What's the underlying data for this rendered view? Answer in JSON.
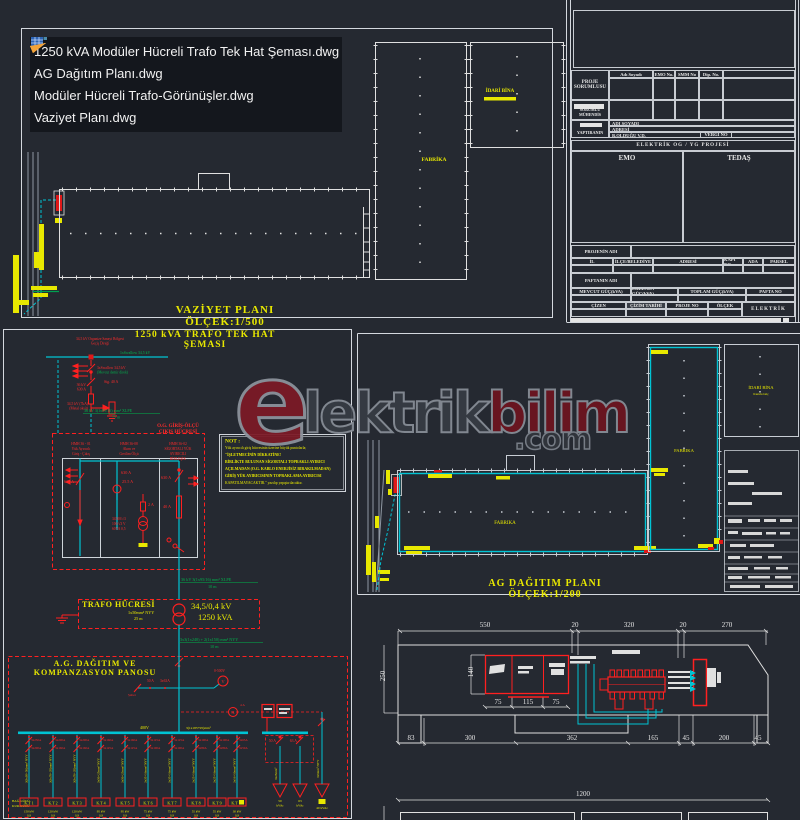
{
  "file_list": {
    "items": [
      "1250 kVA Modüler Hücreli Trafo Tek Hat Şeması.dwg",
      "AG Dağıtım Planı.dwg",
      "Modüler Hücreli Trafo-Görünüşler.dwg",
      "Vaziyet Planı.dwg"
    ]
  },
  "watermark": {
    "logo_letter": "e",
    "part1": "lektrik",
    "part2": "bilim",
    "suffix": ".com"
  },
  "vaziyet": {
    "title": "VAZİYET PLANI ÖLÇEK:1/500",
    "fabrika": "FABRİKA",
    "idari_bina": "İDARİ BİNA"
  },
  "title_block": {
    "proje_sorumlusu": "PROJE SORUMLUSU",
    "adi_soyadi": "Adı Soyadı",
    "emo_no": "EMO No.",
    "smm_no": "SMM No",
    "dip_no": "Dip. No.",
    "sorumlu": "SORUMLU MÜHENDİS",
    "yaptiranin": "YAPTIRANIN",
    "row_adi": "ADI SOYADI",
    "row_adresi": "ADRESİ",
    "row_vd": "B.OLDUĞU V.D.",
    "vergi": "VERGİ NO",
    "band": "ELEKTRİK OG / YG PROJESİ",
    "emo": "EMO",
    "tedas": "TEDAŞ",
    "projenin_adi": "PROJENİN ADI",
    "il": "İL",
    "ilce": "İLÇE/BELEDİYE",
    "adresi": "ADRESİ",
    "kapi_no": "KAPI NO",
    "ada": "ADA",
    "parsel": "PARSEL",
    "paftanin_adi": "PAFTANIN ADI",
    "mevcut": "MEVCUT GÜÇ(kVA)",
    "eklenen": "EKLENEN GÜÇ(kVA)",
    "toplam": "TOPLAM GÜÇ(kVA)",
    "pafta_no": "PAFTA NO",
    "cizen": "ÇİZEN",
    "cizim_tarihi": "ÇİZİM TARİHİ",
    "proje_no": "PROJE NO",
    "olcek": "ÖLÇEK",
    "elektrik": "ELEKTRİK"
  },
  "tekhat": {
    "title": "1250 kVA TRAFO TEK HAT ŞEMASI",
    "incoming_line1": "34,5 kV Organize Sanayi Bölgesi",
    "incoming_line2": "Geçiş Direği",
    "conductor": "1xSwallow 34,5 kV",
    "branch_red": "3xSwallow 34,5 kV",
    "branch_green": "(Mevcut demir direk)",
    "switch_label1": "36 kV",
    "switch_label2": "630 A",
    "fuse_label": "Sig. 40 A",
    "arrester1": "34,5 kV (7kA)",
    "arrester2": "(Metal oksit)",
    "drop_cable": "36 kV 3(1x95/16) mm² XLPE",
    "drop_cable_len": "75 m",
    "og_label1": "O.G. GİRİŞ-ÖLÇÜ",
    "og_label2": "ÇIKIŞ HÜCRESİ",
    "cells": [
      {
        "l1": "HMH 36 - 01",
        "l2": "Yük Ayırıcılı",
        "l3": "Giriş - Çıkış",
        "l4": ""
      },
      {
        "l1": "HMH 36-08",
        "l2": "Akım ve",
        "l3": "Gerilim Ölçü",
        "l4": ""
      },
      {
        "l1": "HMH 36-02",
        "l2": "SİGORTALI YÜK",
        "l3": "AYIRICILI",
        "l4": "BİRLEŞİK"
      }
    ],
    "r630_1": "630 A",
    "r630_2": "630 A",
    "r255": "25.5 A",
    "r2": "2 A",
    "r40": "40 A",
    "r630_3": "630 A",
    "vt1": "34500/√3",
    "vt2": "100/√3 V",
    "vt3": "60VA 0,5",
    "out_cable1": "36 kV 3(1x95/16) mm² XLPE",
    "out_cable1_len": "10 m",
    "not_title": "NOT :",
    "not_lines": [
      "Yük ayırıcılı giriş hücresinin üzerine büyük puntolarla;",
      "\"İŞLETMECİNİN DİKKATİNE!",
      "BİRLİKTE BULUNAN SİGORTALI TOPRAKLI AYIRICI",
      "AÇILMADAN (O.G. KABLO ENERJİSİZ BIRAKILMADAN)",
      "GİRİŞ YÜK AYIRICISININ TOPRAKLAMA AYIRICISI",
      "KAPATILMAYACAKTIR.\" yazılıp yapıştırılacaktır."
    ],
    "trafo_box": "TRAFO HÜCRESİ",
    "trafo_cable": "1x50mm² NYY",
    "trafo_cable_len": "25 m",
    "trafo_kv": "34,5/0,4 kV",
    "trafo_kva": "1250 kVA",
    "out_cable2": "3x3(1x240) + 2(1x150) mm² NYY",
    "out_cable2_len": "10 m",
    "ag_title1": "A.G. DAĞITIM VE",
    "ag_title2": "KOMPANZASYON PANOSU",
    "voltmeter": "V",
    "voltmeter_range": "0-500V",
    "ammeter": "A",
    "ammeter_label": "4 A",
    "salter": "Şalter",
    "sw_a": "50 A",
    "sw_b": "3x63A",
    "busbar_label": "400V",
    "busbar_spec": "3(1x185+95)mm²",
    "corner1": "BAĞ.GÜCÜ",
    "corner2": "KUR.GÜCÜ",
    "feeders": [
      {
        "a": "3x250A",
        "b": "3x200A",
        "c": "3(3x95+50)mm² NYY",
        "tag": "K.T 1",
        "l1": "150 kW",
        "l2": "0,9"
      },
      {
        "a": "3x200A",
        "b": "3x160A",
        "c": "3(3x70+35)mm² NYY",
        "tag": "K.T 2",
        "l1": "120 kW",
        "l2": "0,9"
      },
      {
        "a": "3x200A",
        "b": "3x160A",
        "c": "3(3x70+35)mm² NYY",
        "tag": "K.T 3",
        "l1": "120 kW",
        "l2": "0,9"
      },
      {
        "a": "3x160A",
        "b": "3x125A",
        "c": "3x50+25mm² NYY",
        "tag": "K.T 4",
        "l1": "95 kW",
        "l2": "0,9"
      },
      {
        "a": "3x160A",
        "b": "3x125A",
        "c": "3x50+25mm² NYY",
        "tag": "K.T 5",
        "l1": "95 kW",
        "l2": "0,9"
      },
      {
        "a": "3x125A",
        "b": "3x100A",
        "c": "3x35+16mm² NYY",
        "tag": "K.T 6",
        "l1": "75 kW",
        "l2": "0,9"
      },
      {
        "a": "3x125A",
        "b": "3x100A",
        "c": "3x35+16mm² NYY",
        "tag": "K.T 7",
        "l1": "75 kW",
        "l2": "0,9"
      },
      {
        "a": "3x100A",
        "b": "3x80A",
        "c": "3x25+16mm² NYY",
        "tag": "K.T 8",
        "l1": "55 kW",
        "l2": "0,9"
      },
      {
        "a": "3x100A",
        "b": "3x80A",
        "c": "3x25+16mm² NYY",
        "tag": "K.T 9",
        "l1": "55 kW",
        "l2": "0,9"
      },
      {
        "a": "3x63A",
        "b": "3x50A",
        "c": "3x16+10mm² NYY",
        "tag": "K.T 10",
        "l1": "30 kW",
        "l2": "0,9"
      }
    ],
    "comp": {
      "b1": "50 A",
      "b2": "63 A",
      "c1a": "50",
      "c1b": "kVAr",
      "c2a": "63",
      "c2b": "kVAr",
      "c3": "40 kVAr",
      "cable1": "3x25mm²",
      "cable2": "3x6mm² NYY"
    }
  },
  "agplan": {
    "title": "AG DAĞITIM PLANI ÖLÇEK:1/200",
    "fabrika1": "FABRIKA",
    "fabrika2": "FABRIKA",
    "idari": "İDARİ BİNA",
    "idari_sub": "Kurulu Güç"
  },
  "dims": {
    "top": [
      "550",
      "20",
      "320",
      "20",
      "270"
    ],
    "left": [
      "250",
      "140"
    ],
    "cells": [
      "75",
      "115",
      "75"
    ],
    "bottom": [
      "83",
      "300",
      "362",
      "165",
      "45",
      "200",
      "45"
    ],
    "lower": "1200"
  }
}
